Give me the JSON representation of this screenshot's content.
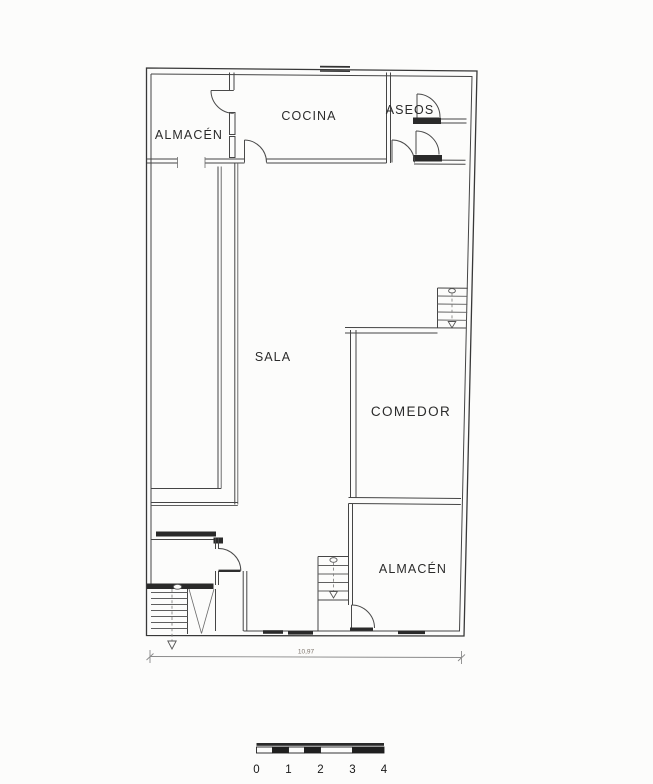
{
  "rooms": {
    "almacen_top": "ALMACÉN",
    "cocina": "COCINA",
    "aseos": "ASEOS",
    "sala": "SALA",
    "comedor": "COMEDOR",
    "almacen_bottom": "ALMACÉN"
  },
  "dimension": {
    "total_width": "10,97"
  },
  "scale_bar": {
    "labels": [
      "0",
      "1",
      "2",
      "3",
      "4"
    ]
  },
  "colors": {
    "ink": "#3f3f3f",
    "ink_dark": "#2a2a2a",
    "ink_light": "#6e6e6e",
    "paper": "#fcfcfb"
  }
}
